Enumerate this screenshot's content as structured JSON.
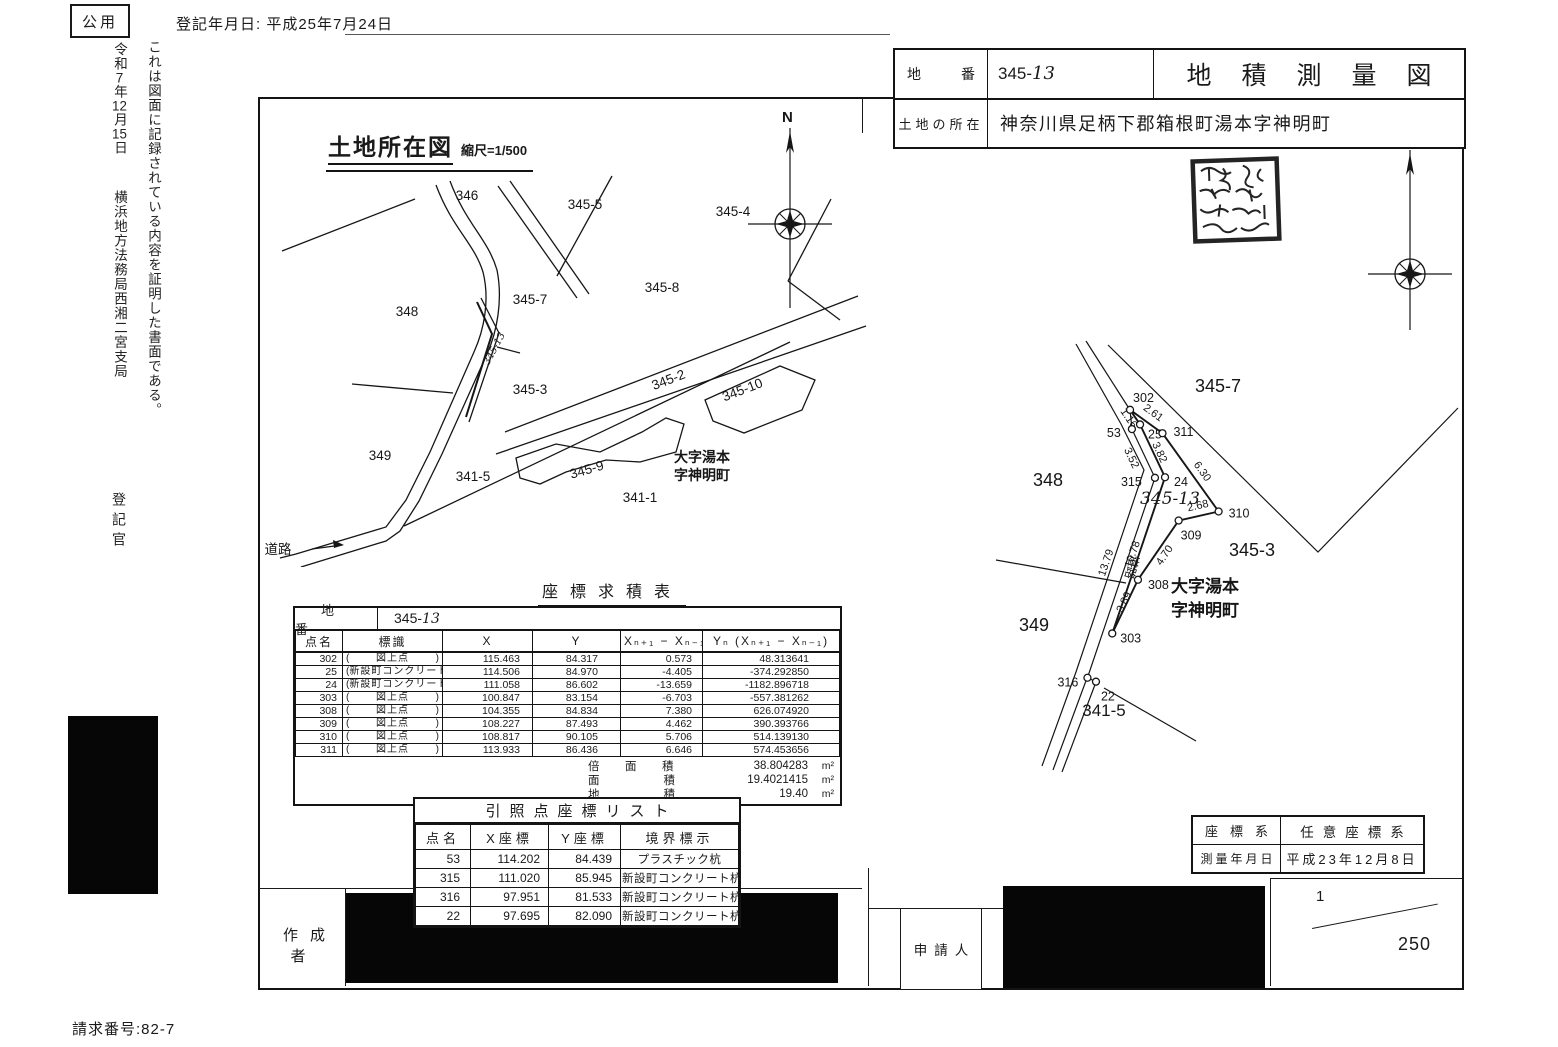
{
  "page": {
    "classification": "公用",
    "registration_date": "登記年月日: 平成25年7月24日",
    "certificate_text": "これは図面に記録されている内容を証明した書面である。",
    "certificate_date": "令和7年12月15日",
    "office": "横浜地方法務局西湘二宮支局",
    "registrar": "登記官",
    "request_number": "請求番号:82-7"
  },
  "header": {
    "parcel_label": "地番",
    "parcel_number": {
      "printed": "345-",
      "handwritten": "13"
    },
    "title": "地積測量図",
    "location_label": "土地の所在",
    "location": "神奈川県足柄下郡箱根町湯本字神明町"
  },
  "seal": {
    "name": "registrar-seal",
    "description": "illegible-square-seal"
  },
  "site_map": {
    "title": "土地所在図",
    "scale_note": "縮尺=1/500",
    "north_label": "N",
    "road_label": "道路",
    "labels": [
      {
        "t": "346",
        "x": 467,
        "y": 200
      },
      {
        "t": "345-5",
        "x": 585,
        "y": 209
      },
      {
        "t": "345-4",
        "x": 733,
        "y": 216
      },
      {
        "t": "348",
        "x": 407,
        "y": 316
      },
      {
        "t": "345-7",
        "x": 530,
        "y": 304
      },
      {
        "t": "345-8",
        "x": 662,
        "y": 292
      },
      {
        "t": "345-3",
        "x": 530,
        "y": 394
      },
      {
        "t": "345-2",
        "x": 670,
        "y": 384,
        "r": -21
      },
      {
        "t": "345-10",
        "x": 744,
        "y": 394,
        "r": -21
      },
      {
        "t": "349",
        "x": 380,
        "y": 460
      },
      {
        "t": "341-5",
        "x": 473,
        "y": 481
      },
      {
        "t": "345-9",
        "x": 588,
        "y": 474,
        "r": -16
      },
      {
        "t": "341-1",
        "x": 640,
        "y": 502
      },
      {
        "t": "大字湯本",
        "x": 702,
        "y": 462,
        "b": 1,
        "s": 14
      },
      {
        "t": "字神明町",
        "x": 702,
        "y": 480,
        "b": 1,
        "s": 14
      },
      {
        "t": "道路",
        "x": 278,
        "y": 554
      },
      {
        "t": "345-13",
        "x": 497,
        "y": 350,
        "r": -62,
        "hand": 1,
        "s": 10
      }
    ]
  },
  "survey_map": {
    "north_label": "N",
    "points": {
      "302": [
        115.463,
        84.317
      ],
      "25": [
        114.506,
        84.97
      ],
      "24": [
        111.058,
        86.602
      ],
      "303": [
        100.847,
        83.154
      ],
      "308": [
        104.355,
        84.834
      ],
      "309": [
        108.227,
        87.493
      ],
      "310": [
        108.817,
        90.105
      ],
      "311": [
        113.933,
        86.436
      ],
      "53": [
        114.202,
        84.439
      ],
      "315": [
        111.02,
        85.945
      ],
      "316": [
        97.951,
        81.533
      ],
      "22": [
        97.695,
        82.09
      ]
    },
    "parcel_edges": [
      [
        "302",
        "25",
        "1.16",
        -9,
        3
      ],
      [
        "25",
        "24",
        "3.82",
        4,
        3
      ],
      [
        "24",
        "303",
        "10.78",
        -3,
        0
      ],
      [
        "303",
        "308",
        "3.89",
        2,
        -3
      ],
      [
        "308",
        "309",
        "4.70",
        9,
        7
      ],
      [
        "309",
        "310",
        "2.68",
        0,
        -7
      ],
      [
        "310",
        "311",
        "6.30",
        9,
        1
      ],
      [
        "311",
        "302",
        "2.61",
        5,
        -6
      ]
    ],
    "ref_edges": [
      [
        "53",
        "315",
        "3.52",
        -15,
        6
      ],
      [
        "315",
        "316",
        "13.79",
        -12,
        -14
      ],
      [
        "316",
        "22",
        "",
        0,
        0
      ]
    ],
    "label_offsets": {
      "302": [
        3,
        -8
      ],
      "25": [
        8,
        14
      ],
      "24": [
        9,
        9
      ],
      "303": [
        8,
        9
      ],
      "308": [
        10,
        9
      ],
      "309": [
        2,
        19
      ],
      "310": [
        10,
        6
      ],
      "311": [
        11,
        3
      ],
      "53": [
        -25,
        8
      ],
      "315": [
        -34,
        8
      ],
      "316": [
        -30,
        9
      ],
      "22": [
        5,
        19
      ]
    },
    "region_labels": [
      {
        "t": "345-7",
        "x": 1218,
        "y": 392,
        "s": 18
      },
      {
        "t": "348",
        "x": 1048,
        "y": 486,
        "s": 18
      },
      {
        "t": "345-3",
        "x": 1252,
        "y": 556,
        "s": 18
      },
      {
        "t": "349",
        "x": 1034,
        "y": 631,
        "s": 18
      },
      {
        "t": "341-5",
        "x": 1104,
        "y": 716,
        "s": 17
      },
      {
        "t": "大字湯本",
        "x": 1205,
        "y": 592,
        "s": 17,
        "b": 1
      },
      {
        "t": "字神明町",
        "x": 1205,
        "y": 616,
        "s": 17,
        "b": 1
      },
      {
        "t": "345-13",
        "x": 1170,
        "y": 504,
        "s": 17,
        "hand": 1
      },
      {
        "t": "道路",
        "x": 1128,
        "y": 566,
        "s": 12,
        "r": 106
      }
    ]
  },
  "coord_table": {
    "title": "座標求積表",
    "parcel_label": "地番",
    "parcel_number": {
      "printed": "345-",
      "handwritten": "13"
    },
    "headers": {
      "name": "点名",
      "mark": "標識",
      "x": "X",
      "y": "Y",
      "dx": "Xₙ₊₁ − Xₙ₋₁",
      "ydx": "Yₙ (Xₙ₊₁ − Xₙ₋₁)"
    },
    "rows": [
      {
        "name": "302",
        "mark": "図上点",
        "x": "115.463",
        "y": "84.317",
        "dx": "0.573",
        "ydx": "48.313641"
      },
      {
        "name": "25",
        "mark": "新設町コンクリート杭",
        "x": "114.506",
        "y": "84.970",
        "dx": "-4.405",
        "ydx": "-374.292850"
      },
      {
        "name": "24",
        "mark": "新設町コンクリート杭",
        "x": "111.058",
        "y": "86.602",
        "dx": "-13.659",
        "ydx": "-1182.896718"
      },
      {
        "name": "303",
        "mark": "図上点",
        "x": "100.847",
        "y": "83.154",
        "dx": "-6.703",
        "ydx": "-557.381262"
      },
      {
        "name": "308",
        "mark": "図上点",
        "x": "104.355",
        "y": "84.834",
        "dx": "7.380",
        "ydx": "626.074920"
      },
      {
        "name": "309",
        "mark": "図上点",
        "x": "108.227",
        "y": "87.493",
        "dx": "4.462",
        "ydx": "390.393766"
      },
      {
        "name": "310",
        "mark": "図上点",
        "x": "108.817",
        "y": "90.105",
        "dx": "5.706",
        "ydx": "514.139130"
      },
      {
        "name": "311",
        "mark": "図上点",
        "x": "113.933",
        "y": "86.436",
        "dx": "6.646",
        "ydx": "574.453656"
      }
    ],
    "footer": [
      {
        "label": "倍面積",
        "value": "38.804283",
        "unit": "m²"
      },
      {
        "label": "面積",
        "value": "19.4021415",
        "unit": "m²"
      },
      {
        "label": "地積",
        "value": "19.40",
        "unit": "m²"
      }
    ]
  },
  "ref_table": {
    "title": "引照点座標リスト",
    "headers": [
      "点名",
      "X座標",
      "Y座標",
      "境界標示"
    ],
    "rows": [
      [
        "53",
        "114.202",
        "84.439",
        "プラスチック杭"
      ],
      [
        "315",
        "111.020",
        "85.945",
        "新設町コンクリート杭"
      ],
      [
        "316",
        "97.951",
        "81.533",
        "新設町コンクリート杭"
      ],
      [
        "22",
        "97.695",
        "82.090",
        "新設町コンクリート杭"
      ]
    ]
  },
  "meta_table": {
    "coord_system_label": "座標系",
    "coord_system_value": "任意座標系",
    "survey_date_label": "測量年月日",
    "survey_date_value": "平成23年12月8日"
  },
  "footer": {
    "author_label": "作成者",
    "applicant_label": "申請人",
    "scale_numerator": "1",
    "scale_denominator": "250"
  }
}
